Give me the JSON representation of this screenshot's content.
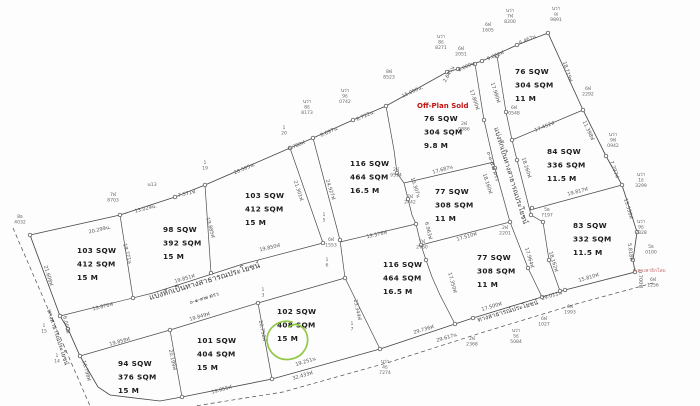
{
  "map": {
    "title": "land-subdivision-survey-plan",
    "units_note": "SQW = square wah, SQM = square meters, M = frontage meters",
    "plots": [
      {
        "lines": [
          "103 SQW",
          "412 SQM",
          "15 M"
        ],
        "x": 77,
        "y": 253
      },
      {
        "lines": [
          "98 SQW",
          "392 SQM",
          "15 M"
        ],
        "x": 163,
        "y": 232
      },
      {
        "lines": [
          "103 SQW",
          "412 SQM",
          "15 M"
        ],
        "x": 245,
        "y": 198
      },
      {
        "lines": [
          "116 SQW",
          "464 SQM",
          "16.5 M"
        ],
        "x": 350,
        "y": 166
      },
      {
        "lines": [
          "76 SQW",
          "304 SQM",
          "9.8 M"
        ],
        "x": 424,
        "y": 121,
        "status": "Off-Plan Sold"
      },
      {
        "lines": [
          "76 SQW",
          "304 SQM",
          "11 M"
        ],
        "x": 515,
        "y": 74
      },
      {
        "lines": [
          "84 SQW",
          "336 SQM",
          "11.5 M"
        ],
        "x": 547,
        "y": 154
      },
      {
        "lines": [
          "77 SQW",
          "308 SQM",
          "11 M"
        ],
        "x": 435,
        "y": 194
      },
      {
        "lines": [
          "116 SQW",
          "464 SQM",
          "16.5 M"
        ],
        "x": 383,
        "y": 267
      },
      {
        "lines": [
          "77 SQW",
          "308 SQM",
          "11 M"
        ],
        "x": 477,
        "y": 260
      },
      {
        "lines": [
          "83 SQW",
          "332 SQM",
          "11.5 M"
        ],
        "x": 573,
        "y": 228
      },
      {
        "lines": [
          "94 SQW",
          "376 SQM",
          "15 M"
        ],
        "x": 118,
        "y": 366
      },
      {
        "lines": [
          "101 SQW",
          "404 SQM",
          "15 M"
        ],
        "x": 197,
        "y": 343
      },
      {
        "lines": [
          "102 SQW",
          "408 SQM",
          "15 M"
        ],
        "x": 277,
        "y": 314,
        "highlighted": true
      }
    ],
    "off_plan": {
      "label": "Off-Plan Sold",
      "x": 417,
      "y": 108
    },
    "red_note": {
      "label": "ฝ่ ทางสาธิกโลม",
      "x": 633,
      "y": 272
    },
    "roads": {
      "r1_label": "แบ่งหักเป็นทางสาธารณประโยชน์",
      "r1_note": "๐-๑-๙๗ ตรว",
      "r2_label": "แบ่งหักเป็นทางสาธารณประโยชน์",
      "r2_note": "๐-๐-๕๘ ตรว",
      "left_label": "ทางสาธารณประโยชน์",
      "bottom_label": "ทางสาธารณ์ประโยชน์"
    },
    "distances": [
      {
        "t": "20.299น.",
        "x": 100,
        "y": 231,
        "r": -13
      },
      {
        "t": "13.029น.",
        "x": 146,
        "y": 210,
        "r": -14
      },
      {
        "t": "7.571ฬ",
        "x": 187,
        "y": 195,
        "r": -13
      },
      {
        "t": "20.505น.",
        "x": 245,
        "y": 170,
        "r": -23
      },
      {
        "t": "6.780ฬ",
        "x": 297,
        "y": 147,
        "r": -23
      },
      {
        "t": "8.697น.",
        "x": 330,
        "y": 133,
        "r": -24
      },
      {
        "t": "8.722น.",
        "x": 366,
        "y": 117,
        "r": -24
      },
      {
        "t": "15.000น.",
        "x": 413,
        "y": 93,
        "r": -25
      },
      {
        "t": "2.641น",
        "x": 450,
        "y": 75,
        "r": -60
      },
      {
        "t": "6.000น",
        "x": 467,
        "y": 68,
        "r": -25
      },
      {
        "t": "9.060ฬ",
        "x": 496,
        "y": 57,
        "r": -23
      },
      {
        "t": "6.467น",
        "x": 528,
        "y": 41,
        "r": -23
      },
      {
        "t": "18.719ฬ",
        "x": 566,
        "y": 72,
        "r": 72
      },
      {
        "t": "11.398ฬ",
        "x": 587,
        "y": 131,
        "r": 65
      },
      {
        "t": "7.297ฬ",
        "x": 613,
        "y": 170,
        "r": 70
      },
      {
        "t": "13.536ฬ",
        "x": 627,
        "y": 209,
        "r": 73
      },
      {
        "t": "5.818ฬ",
        "x": 629,
        "y": 252,
        "r": 83
      },
      {
        "t": "0.700ฬ",
        "x": 639,
        "y": 279,
        "r": 87
      },
      {
        "t": "15.810ฬ",
        "x": 589,
        "y": 279,
        "r": -16
      },
      {
        "t": "29.011น",
        "x": 552,
        "y": 297,
        "r": -17
      },
      {
        "t": "17.500ฬ",
        "x": 492,
        "y": 308,
        "r": -17
      },
      {
        "t": "29.736ฬ",
        "x": 424,
        "y": 331,
        "r": -17
      },
      {
        "t": "29.617น",
        "x": 447,
        "y": 339,
        "r": -17
      },
      {
        "t": "19.251น",
        "x": 306,
        "y": 363,
        "r": -17
      },
      {
        "t": "32.433ฬ",
        "x": 303,
        "y": 377,
        "r": -17
      },
      {
        "t": "19.855ฬ",
        "x": 222,
        "y": 391,
        "r": -15
      },
      {
        "t": "21.608ฬ",
        "x": 47,
        "y": 276,
        "r": 73
      },
      {
        "t": "6.000ฬ",
        "x": 65,
        "y": 325,
        "r": 78
      },
      {
        "t": "16.798ฬ",
        "x": 85,
        "y": 371,
        "r": 75
      },
      {
        "t": "19.870ฬ",
        "x": 103,
        "y": 308,
        "r": -14
      },
      {
        "t": "19.851ฬ",
        "x": 185,
        "y": 280,
        "r": -16
      },
      {
        "t": "19.850ฬ",
        "x": 270,
        "y": 249,
        "r": -13
      },
      {
        "t": "19.858ฬ",
        "x": 120,
        "y": 343,
        "r": -15
      },
      {
        "t": "19.849ฬ",
        "x": 200,
        "y": 318,
        "r": -16
      },
      {
        "t": "19.771น",
        "x": 126,
        "y": 254,
        "r": 75
      },
      {
        "t": "19.885ฬ",
        "x": 209,
        "y": 228,
        "r": 75
      },
      {
        "t": "21.301ฬ",
        "x": 297,
        "y": 191,
        "r": 72
      },
      {
        "t": "24.927ฬ",
        "x": 329,
        "y": 190,
        "r": 72
      },
      {
        "t": "19.576ฬ",
        "x": 377,
        "y": 236,
        "r": -13
      },
      {
        "t": "10.307น",
        "x": 414,
        "y": 188,
        "r": 72
      },
      {
        "t": "6.963ฬ",
        "x": 427,
        "y": 231,
        "r": 77
      },
      {
        "t": "17.350ฬ",
        "x": 451,
        "y": 283,
        "r": 75
      },
      {
        "t": "20.199ฬ",
        "x": 171,
        "y": 360,
        "r": 78
      },
      {
        "t": "20.758ฬ",
        "x": 261,
        "y": 331,
        "r": 78
      },
      {
        "t": "23.344ฬ",
        "x": 356,
        "y": 310,
        "r": 78
      },
      {
        "t": "17.800ฬ",
        "x": 473,
        "y": 100,
        "r": 72
      },
      {
        "t": "17.980ฬ",
        "x": 494,
        "y": 93,
        "r": 72
      },
      {
        "t": "18.160ฬ",
        "x": 486,
        "y": 184,
        "r": 72
      },
      {
        "t": "18.260ฬ",
        "x": 525,
        "y": 168,
        "r": 72
      },
      {
        "t": "17.452ฬ",
        "x": 545,
        "y": 128,
        "r": -22
      },
      {
        "t": "17.687น",
        "x": 443,
        "y": 171,
        "r": -15
      },
      {
        "t": "17.510ฬ",
        "x": 467,
        "y": 238,
        "r": -16
      },
      {
        "t": "17.964ฬ",
        "x": 528,
        "y": 258,
        "r": 73
      },
      {
        "t": "18.162ฬ",
        "x": 552,
        "y": 262,
        "r": 73
      },
      {
        "t": "19.817ฬ",
        "x": 578,
        "y": 193,
        "r": -15
      }
    ],
    "markers": [
      {
        "lines": [
          "8ธ",
          "4032"
        ],
        "x": 20,
        "y": 218
      },
      {
        "lines": [
          "7ฬ",
          "8703"
        ],
        "x": 113,
        "y": 196
      },
      {
        "lines": [
          "ฆ13"
        ],
        "x": 152,
        "y": 186
      },
      {
        "lines": [
          "1",
          "19"
        ],
        "x": 205,
        "y": 164
      },
      {
        "lines": [
          "1",
          "20"
        ],
        "x": 284,
        "y": 129
      },
      {
        "lines": [
          "นว่า",
          "8ธ",
          "8173"
        ],
        "x": 307,
        "y": 103
      },
      {
        "lines": [
          "นว่า",
          "9ธ",
          "0742"
        ],
        "x": 345,
        "y": 92
      },
      {
        "lines": [
          "8ฬ",
          "8523"
        ],
        "x": 389,
        "y": 73
      },
      {
        "lines": [
          "นว่า",
          "8ธ",
          "8271"
        ],
        "x": 441,
        "y": 38
      },
      {
        "lines": [
          "6ฬ",
          "2051"
        ],
        "x": 461,
        "y": 50
      },
      {
        "lines": [
          "6ฬ",
          "1605"
        ],
        "x": 488,
        "y": 26
      },
      {
        "lines": [
          "นว่า",
          "7ฬ",
          "8200"
        ],
        "x": 510,
        "y": 12
      },
      {
        "lines": [
          "นว่า",
          "ฌ",
          "9891"
        ],
        "x": 556,
        "y": 10
      },
      {
        "lines": [
          "6ฬ",
          "2292"
        ],
        "x": 588,
        "y": 90
      },
      {
        "lines": [
          "นว่า",
          "9ฬ",
          "0942"
        ],
        "x": 613,
        "y": 136
      },
      {
        "lines": [
          "นว่า",
          "1ธ",
          "3299"
        ],
        "x": 641,
        "y": 176
      },
      {
        "lines": [
          "นว่า",
          "9ธ",
          "2328"
        ],
        "x": 641,
        "y": 223
      },
      {
        "lines": [
          "5ธ",
          "0100"
        ],
        "x": 651,
        "y": 248
      },
      {
        "lines": [
          "6ฬ",
          "1256"
        ],
        "x": 653,
        "y": 281
      },
      {
        "lines": [
          "2ฬ",
          "0886"
        ],
        "x": 464,
        "y": 125
      },
      {
        "lines": [
          "6ฬ",
          "0548"
        ],
        "x": 514,
        "y": 109
      },
      {
        "lines": [
          "2ฬ",
          "9514"
        ],
        "x": 396,
        "y": 171
      },
      {
        "lines": [
          "7ฬ",
          "2442"
        ],
        "x": 410,
        "y": 198
      },
      {
        "lines": [
          "7ฬ",
          "2760"
        ],
        "x": 422,
        "y": 243
      },
      {
        "lines": [
          "2ฬ",
          "2201"
        ],
        "x": 505,
        "y": 229
      },
      {
        "lines": [
          "5ธ",
          "7197"
        ],
        "x": 547,
        "y": 211
      },
      {
        "lines": [
          "6ฬ",
          "1553"
        ],
        "x": 331,
        "y": 241
      },
      {
        "lines": [
          "1",
          "5"
        ],
        "x": 324,
        "y": 216
      },
      {
        "lines": [
          "1",
          "6"
        ],
        "x": 327,
        "y": 261
      },
      {
        "lines": [
          "1",
          "7"
        ],
        "x": 352,
        "y": 325
      },
      {
        "lines": [
          "1",
          "3"
        ],
        "x": 263,
        "y": 291
      },
      {
        "lines": [
          "1",
          "15"
        ],
        "x": 44,
        "y": 327
      },
      {
        "lines": [
          "1",
          "14"
        ],
        "x": 57,
        "y": 357
      },
      {
        "lines": [
          "นว่า",
          "4ธ",
          "7274"
        ],
        "x": 385,
        "y": 363
      },
      {
        "lines": [
          "6ฬ",
          "1027"
        ],
        "x": 544,
        "y": 320
      },
      {
        "lines": [
          "6ฬ",
          "1993"
        ],
        "x": 570,
        "y": 308
      },
      {
        "lines": [
          "นว่า",
          "5ธ",
          "5084"
        ],
        "x": 516,
        "y": 332
      },
      {
        "lines": [
          "2ฬ",
          "2368"
        ],
        "x": 472,
        "y": 340
      }
    ],
    "geometry": {
      "outer": "30,235 120,215 175,197 205,185 290,148 313,138 353,120 386,106 447,72 458,69 482,61 517,45 548,33 583,110 606,156 622,185 637,232 633,260 635,272 565,290 542,297 473,318 455,324 380,349 272,379 182,397 160,401 110,395 98,387 80,356 68,329 60,316 30,235",
      "internal": [
        "120,215 133,298",
        "205,185 211,273",
        "290,148 323,243",
        "313,138 340,240 345,278",
        "60,316 153,293 243,264 323,243",
        "80,356 170,330 258,303 345,278",
        "340,242 416,224",
        "386,106 394,150 397,173 404,183 408,199 412,215 416,224 421,245 426,260 432,277 440,295 455,324",
        "404,183 494,162",
        "421,245 510,222",
        "475,64 484,120 495,168 510,222 528,268 542,297",
        "497,56 506,112 512,140 517,160 531,215 543,222 549,260 560,291",
        "512,140 583,110",
        "530,210 622,185",
        "170,330 182,397",
        "258,303 272,379",
        "345,278 380,349"
      ],
      "dashed": [
        "13,228 90,406",
        "653,283 576,304 484,332 390,362 283,392 195,406"
      ],
      "vertices": [
        [
          30,
          235
        ],
        [
          120,
          215
        ],
        [
          175,
          197
        ],
        [
          205,
          185
        ],
        [
          290,
          148
        ],
        [
          313,
          138
        ],
        [
          353,
          120
        ],
        [
          386,
          106
        ],
        [
          447,
          72
        ],
        [
          458,
          69
        ],
        [
          482,
          61
        ],
        [
          517,
          45
        ],
        [
          548,
          33
        ],
        [
          583,
          110
        ],
        [
          606,
          156
        ],
        [
          622,
          185
        ],
        [
          637,
          232
        ],
        [
          633,
          260
        ],
        [
          635,
          272
        ],
        [
          565,
          290
        ],
        [
          542,
          297
        ],
        [
          473,
          318
        ],
        [
          455,
          324
        ],
        [
          380,
          349
        ],
        [
          272,
          379
        ],
        [
          182,
          397
        ],
        [
          80,
          356
        ],
        [
          68,
          329
        ],
        [
          60,
          316
        ],
        [
          133,
          298
        ],
        [
          211,
          273
        ],
        [
          323,
          243
        ],
        [
          340,
          240
        ],
        [
          345,
          278
        ],
        [
          416,
          224
        ],
        [
          397,
          173
        ],
        [
          408,
          199
        ],
        [
          421,
          245
        ],
        [
          170,
          330
        ],
        [
          258,
          303
        ],
        [
          475,
          64
        ],
        [
          497,
          56
        ],
        [
          484,
          120
        ],
        [
          506,
          112
        ],
        [
          512,
          140
        ],
        [
          495,
          168
        ],
        [
          517,
          160
        ],
        [
          510,
          222
        ],
        [
          531,
          215
        ],
        [
          528,
          268
        ],
        [
          543,
          222
        ],
        [
          549,
          260
        ],
        [
          560,
          291
        ],
        [
          532,
          208
        ],
        [
          426,
          260
        ]
      ],
      "highlight_path": "M 292,322 C 282,319 271,325 268,334 C 265,343 269,352 277,357 C 286,362 299,359 304,351 C 309,344 309,334 303,328 C 298,323 293,324 289,327"
    }
  }
}
